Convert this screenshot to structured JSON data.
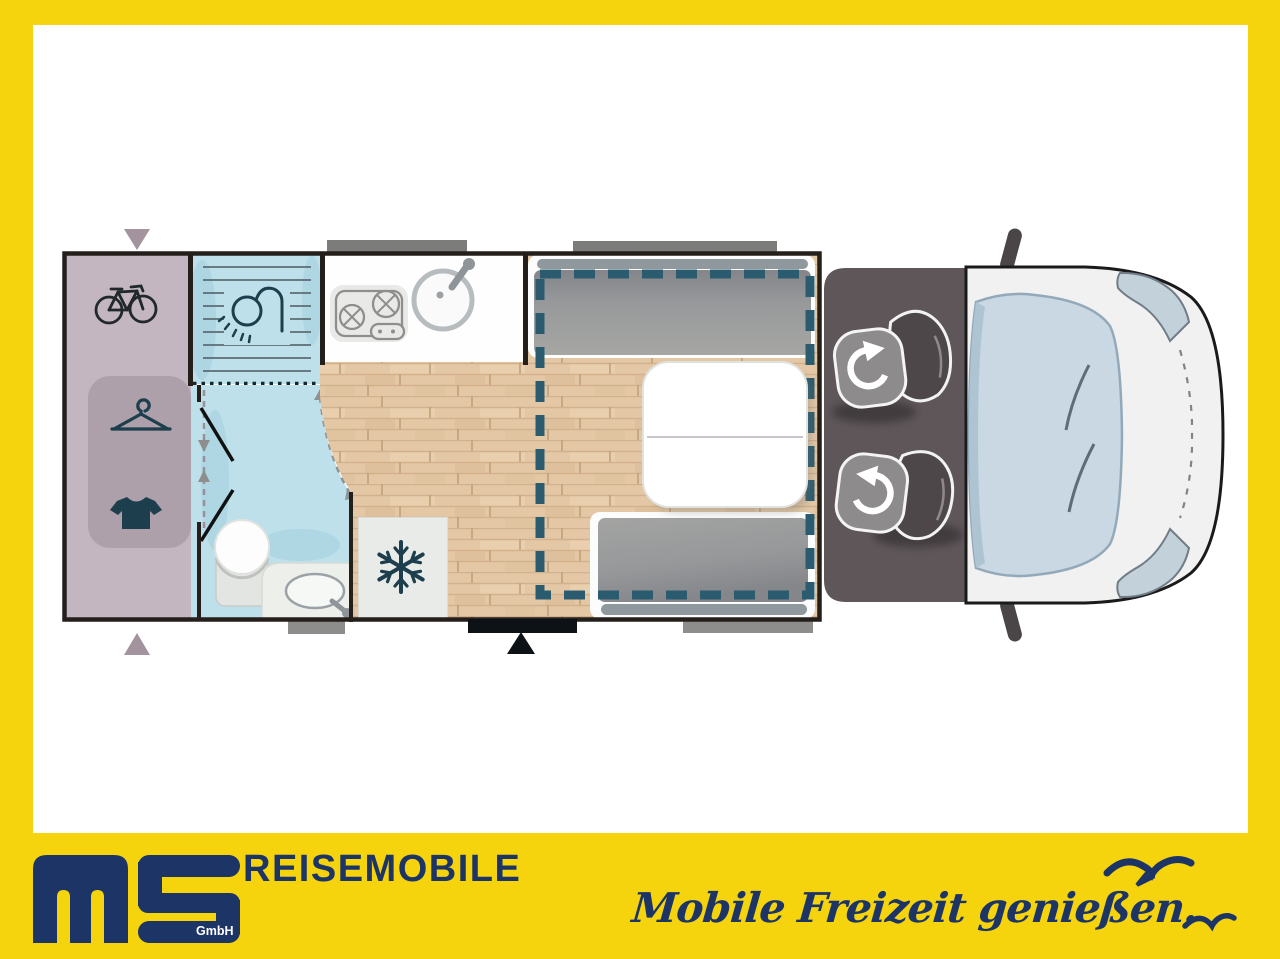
{
  "brand": {
    "logo_text": "ms",
    "logo_suffix": "GmbH",
    "wordmark": "REISEMOBILE",
    "slogan": "Mobile Freizeit genießen."
  },
  "colors": {
    "frame_yellow": "#F5D30D",
    "brand_navy": "#1C3566",
    "floor_wood": "#E4C8A6",
    "bathroom_blue": "#BDE0EA",
    "garage_mauve": "#C4B6C0",
    "garage_mauve_inner": "#ADA0AA",
    "cab_gray": "#5E5658",
    "bed_outline_teal": "#2B5B6E",
    "cushion_gray": "#9B9C9A",
    "icon_teal": "#1D3E4C",
    "wall_dark": "#251F1C"
  },
  "floorplan": {
    "view": "motorhome top view",
    "zones": [
      {
        "name": "rear-garage",
        "icons": [
          "bicycle-icon",
          "hanger-icon",
          "tshirt-icon"
        ]
      },
      {
        "name": "bathroom",
        "icons": [
          "shower-icon",
          "toilet-icon",
          "washbasin-icon"
        ]
      },
      {
        "name": "kitchen",
        "icons": [
          "stove-icon",
          "kitchen-sink-icon"
        ]
      },
      {
        "name": "fridge",
        "icons": [
          "snowflake-icon"
        ]
      },
      {
        "name": "dinette",
        "features": [
          "bench-seat",
          "table",
          "bench-seat",
          "drop-down-bed-outline"
        ]
      },
      {
        "name": "cab",
        "features": [
          "swivel-seat",
          "swivel-seat"
        ]
      },
      {
        "name": "vehicle-front",
        "features": [
          "windshield",
          "headlight",
          "headlight",
          "side-mirror",
          "side-mirror"
        ]
      }
    ],
    "openings": [
      "entry-door",
      "window",
      "window",
      "window",
      "window"
    ]
  }
}
